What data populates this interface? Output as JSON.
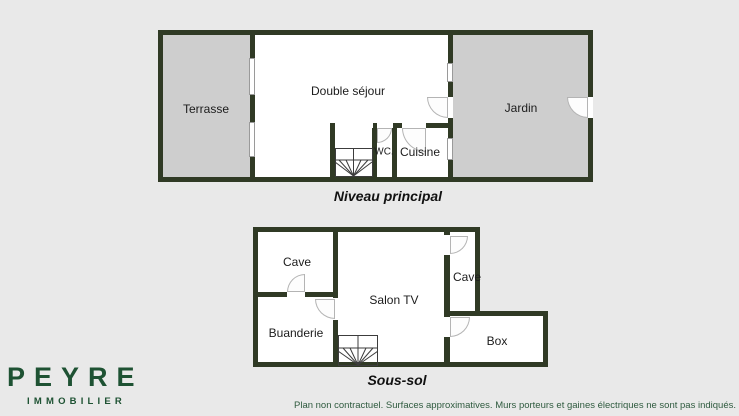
{
  "brand": {
    "name": "PEYRE",
    "tagline": "IMMOBILIER"
  },
  "upper_plan": {
    "title": "Niveau principal",
    "rooms": {
      "terrasse": "Terrasse",
      "sejour": "Double séjour",
      "wc": "WC.",
      "cuisine": "Cuisine",
      "jardin": "Jardin"
    }
  },
  "lower_plan": {
    "title": "Sous-sol",
    "rooms": {
      "cave_left": "Cave",
      "buanderie": "Buanderie",
      "salon_tv": "Salon TV",
      "cave_right": "Cave",
      "box": "Box"
    }
  },
  "footer": {
    "disclaimer": "Plan non contractuel. Surfaces approximatives. Murs porteurs et gaines électriques ne sont pas indiqués."
  },
  "colors": {
    "wall": "#303a25",
    "brand_green": "#1e5233",
    "outdoor_fill": "#cecece",
    "room_fill": "#ffffff",
    "background": "#e9e9e9",
    "disclaimer_text": "#2e5a3e"
  }
}
